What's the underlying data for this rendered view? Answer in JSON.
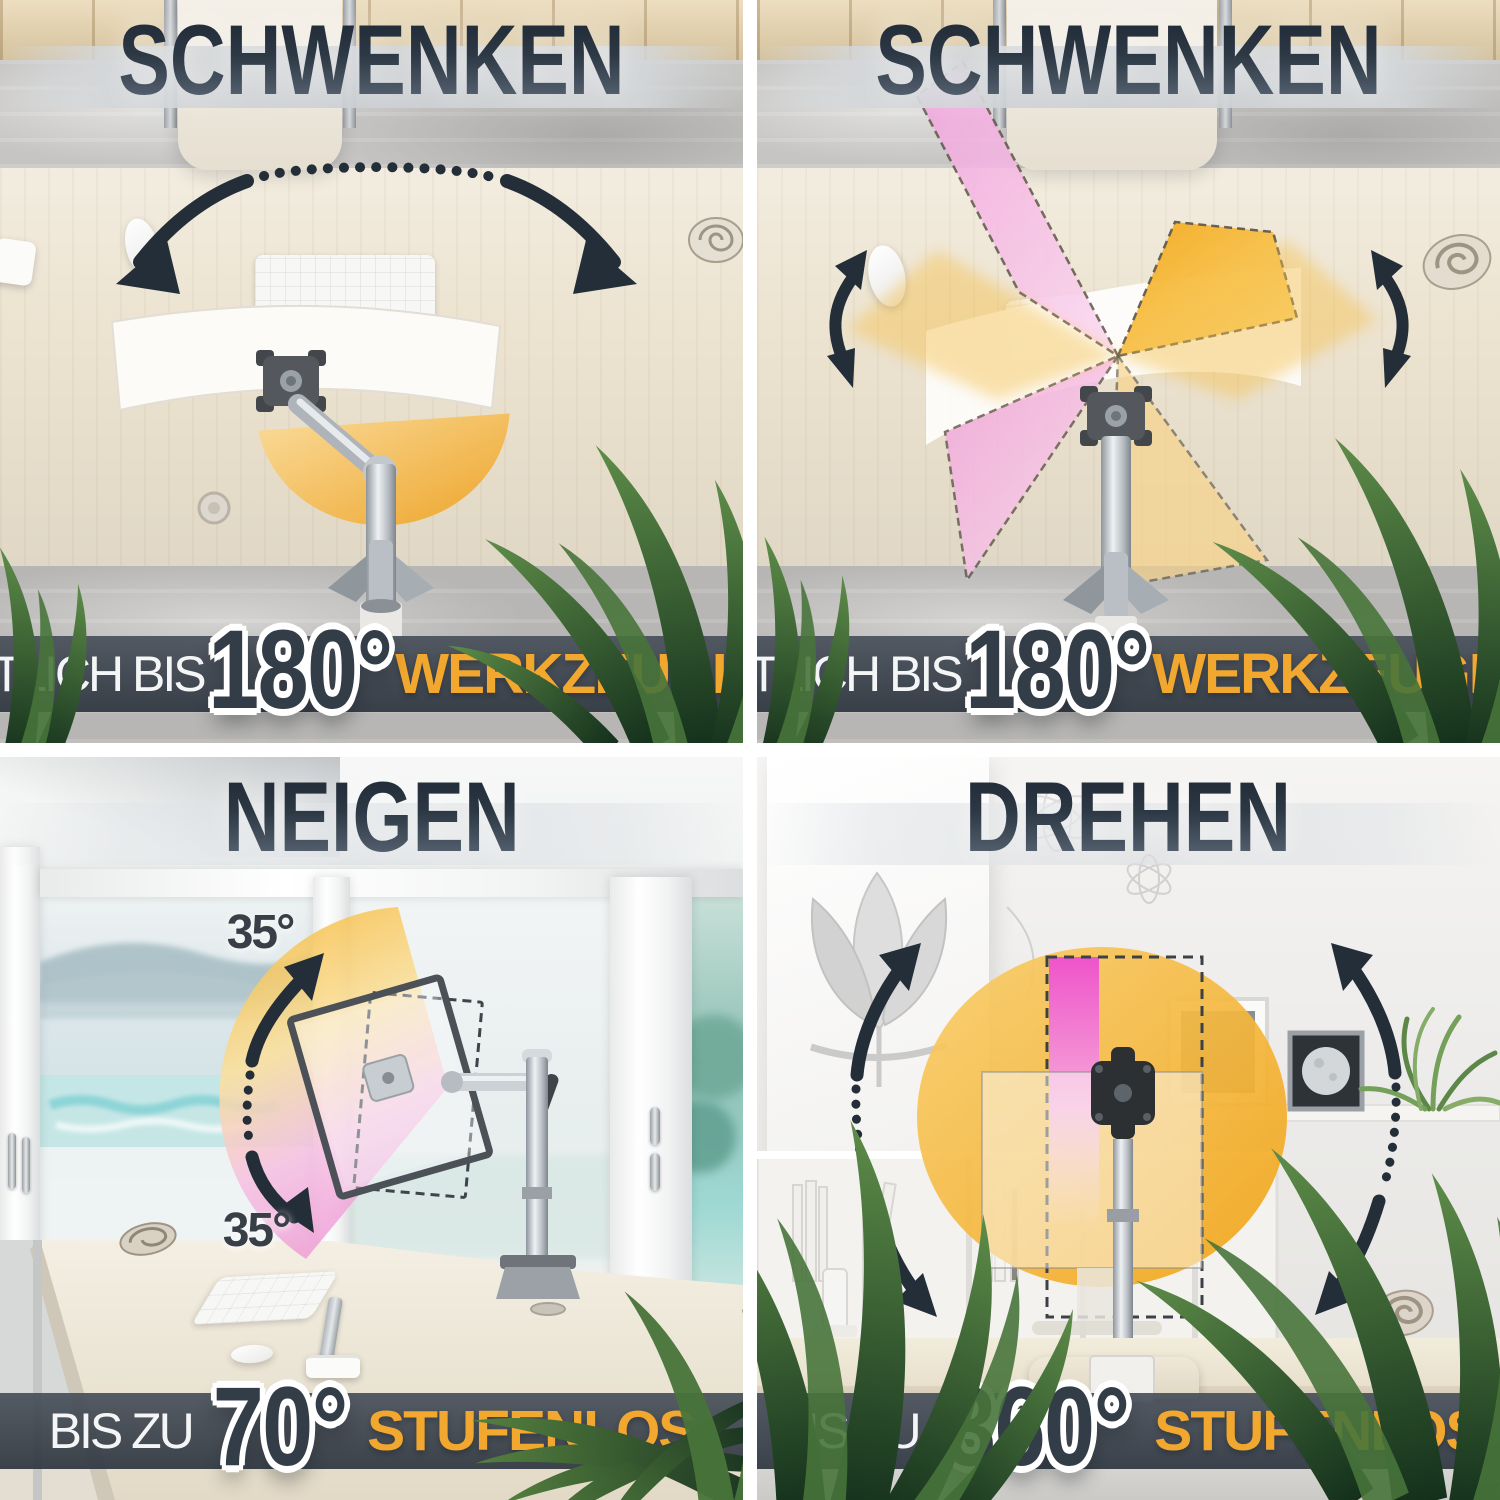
{
  "quadrants": [
    {
      "id": "swivel-arm",
      "title": "SCHWENKEN",
      "banner": {
        "prefix": "SEITLICH BIS",
        "value": "180°",
        "suffix": "WERKZEUGLOS"
      }
    },
    {
      "id": "swivel-pole",
      "title": "SCHWENKEN",
      "banner": {
        "prefix": "SEITLICH BIS",
        "value": "180°",
        "suffix": "WERKZEUGLOS"
      }
    },
    {
      "id": "tilt",
      "title": "NEIGEN",
      "angle_labels": {
        "top": "35°",
        "bottom": "35°"
      },
      "banner": {
        "prefix": "BIS ZU",
        "value": "70°",
        "suffix": "STUFENLOS"
      }
    },
    {
      "id": "rotate",
      "title": "DREHEN",
      "banner": {
        "prefix": "BIS ZU",
        "value": "360°",
        "suffix": "STUFENLOS"
      }
    }
  ],
  "colors": {
    "accent_orange": "#F2A72E",
    "banner_background": "#39424E",
    "title_text_dark": "#27323E",
    "angle_number_fill": "#333D48",
    "angle_number_outline": "#FFFFFF",
    "fan_yellow": "#F4AB20",
    "fan_pink": "#EE6AD4",
    "arrow_dark": "#232E39",
    "plant_green": "#3C5C35"
  },
  "icons": [
    "swivel-arc-arrow-icon",
    "pan-double-arrow-icon",
    "tilt-arc-arrow-icon",
    "rotate-arc-arrow-icon",
    "vesa-plate-icon",
    "seashell-icon",
    "plant-leaves-icon"
  ]
}
